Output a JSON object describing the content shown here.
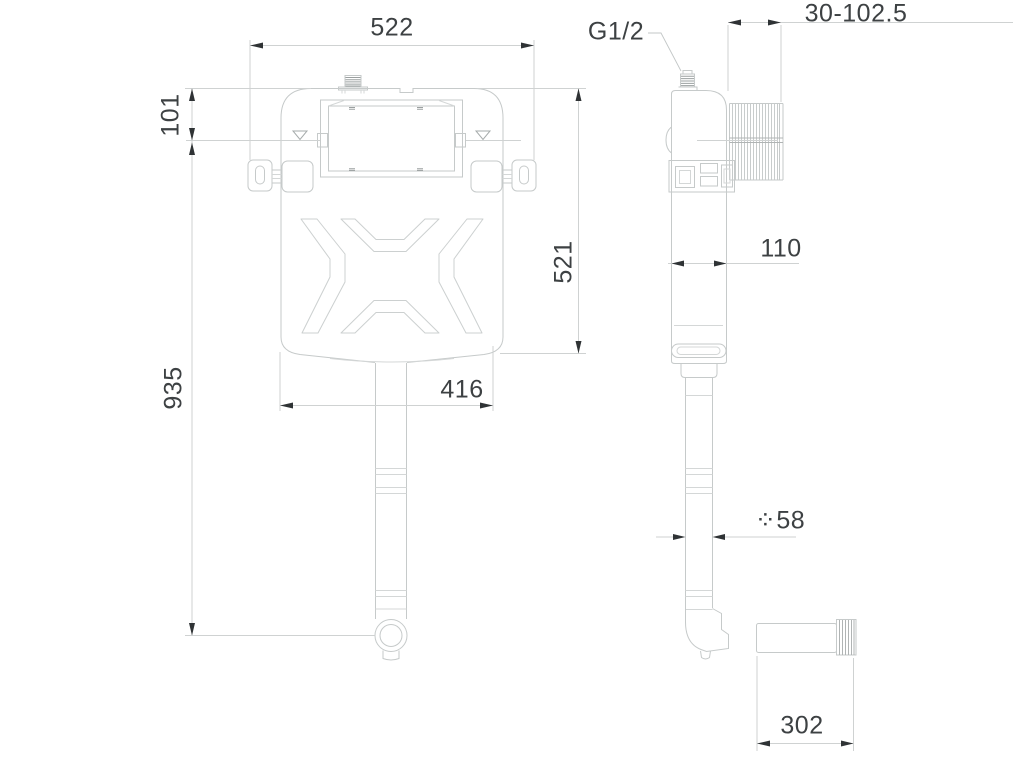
{
  "drawing": {
    "front_view": {
      "top_width": "522",
      "water_level_depth": "101",
      "total_height": "935",
      "tank_height": "521",
      "bottom_width": "416"
    },
    "side_view": {
      "inlet_thread": "G1/2",
      "install_depth_range": "30-102.5",
      "body_depth": "110",
      "flush_pipe_diameter": "⁘58",
      "outlet_pipe_length": "302"
    },
    "colors": {
      "line": "#c6caca",
      "dim_line": "#cfd2d2",
      "arrow": "#2f3335",
      "text": "#3d4143"
    }
  }
}
